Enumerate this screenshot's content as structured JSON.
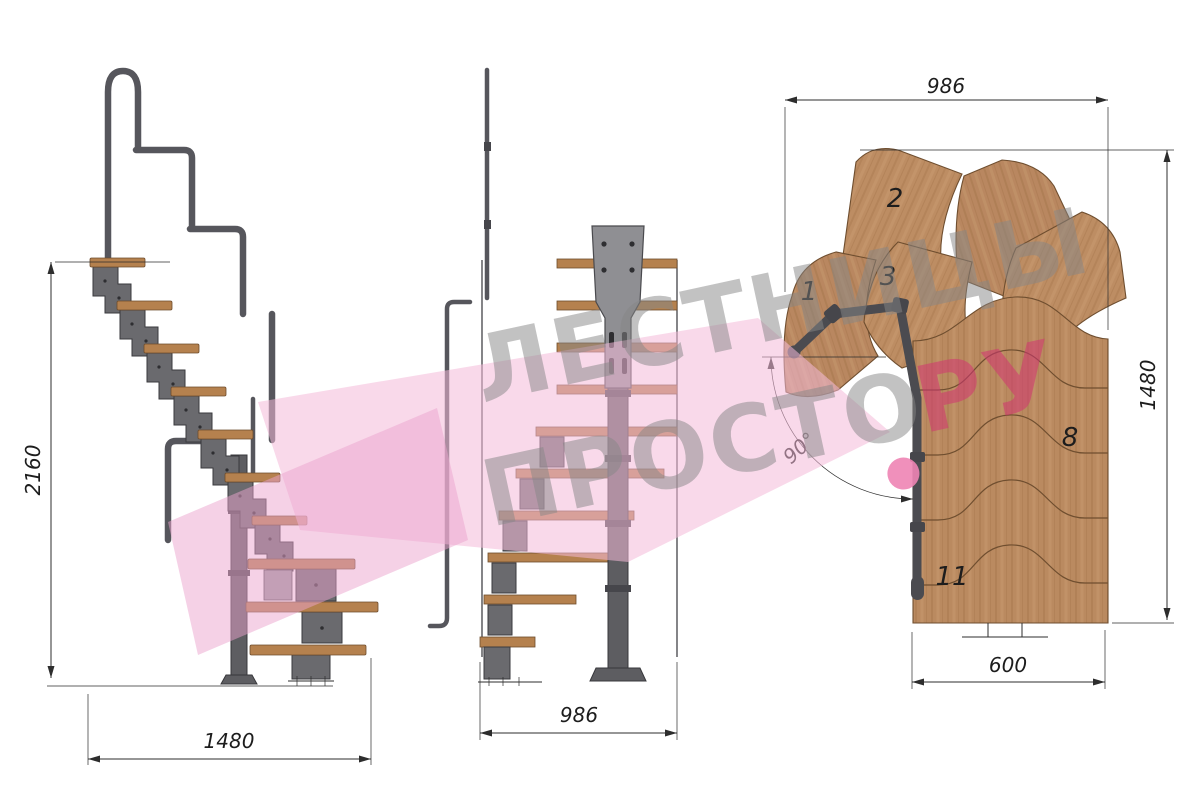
{
  "drawing_title": "modular-staircase-three-view-drawing",
  "views": {
    "side": {
      "label": "side-elevation",
      "dims": {
        "height": "2160",
        "width": "1480"
      }
    },
    "front": {
      "label": "front-elevation",
      "dims": {
        "width": "986"
      }
    },
    "plan": {
      "label": "plan-view",
      "dims": {
        "top": "986",
        "right": "1480",
        "bottom": "600",
        "angle": "90°"
      },
      "treads": {
        "n1": "1",
        "n2": "2",
        "n3": "3",
        "n8": "8",
        "n11": "11"
      }
    }
  },
  "watermark": {
    "line1": "ЛЕСТНИЦЫ",
    "line2": "ПРОСТО",
    "suffix": "РУ",
    "colors": {
      "text_gray": "#878787",
      "suffix_red": "#d23572",
      "dot_pink": "#ee84b4",
      "shape_pink_light": "#f4bad9",
      "shape_pink_dark": "#eba3cd"
    }
  },
  "colors": {
    "background": "#ffffff",
    "wood": "#ba8a60",
    "wood_edge": "#6f4e2f",
    "tread_side": "#b5814e",
    "steel_module": "#6a6a6e",
    "steel_pole": "#5d5d61",
    "handrail_tube": "#56565c",
    "dimension_line": "#2d2d2d"
  }
}
